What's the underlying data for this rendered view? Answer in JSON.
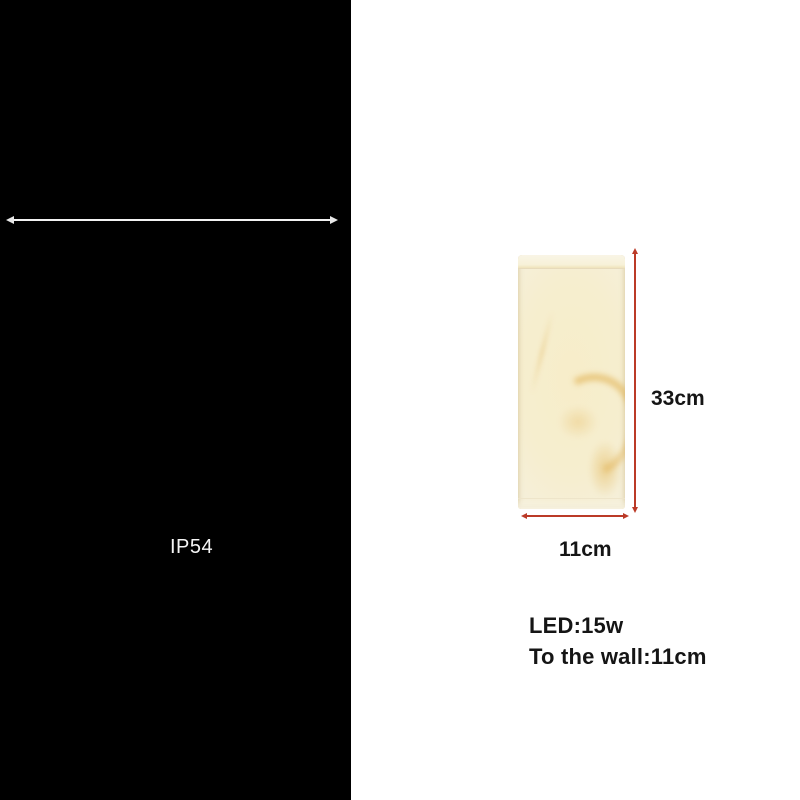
{
  "canvas": {
    "width": 800,
    "height": 800
  },
  "left_panel": {
    "bg_color": "#000000",
    "dimension_line_color": "#f2f2f2",
    "ip_rating": "IP54"
  },
  "right_panel": {
    "bg_color": "#ffffff",
    "lamp": {
      "body_color": "#f7edc9",
      "edge_color": "#f5f0de",
      "cap_color": "#f8f4e3",
      "vein_color": "#dca437"
    },
    "dimension_line_color": "#bb3a27",
    "height_label": "33cm",
    "width_label": "11cm",
    "spec_led": "LED:15w",
    "spec_wall": "To the wall:11cm"
  }
}
